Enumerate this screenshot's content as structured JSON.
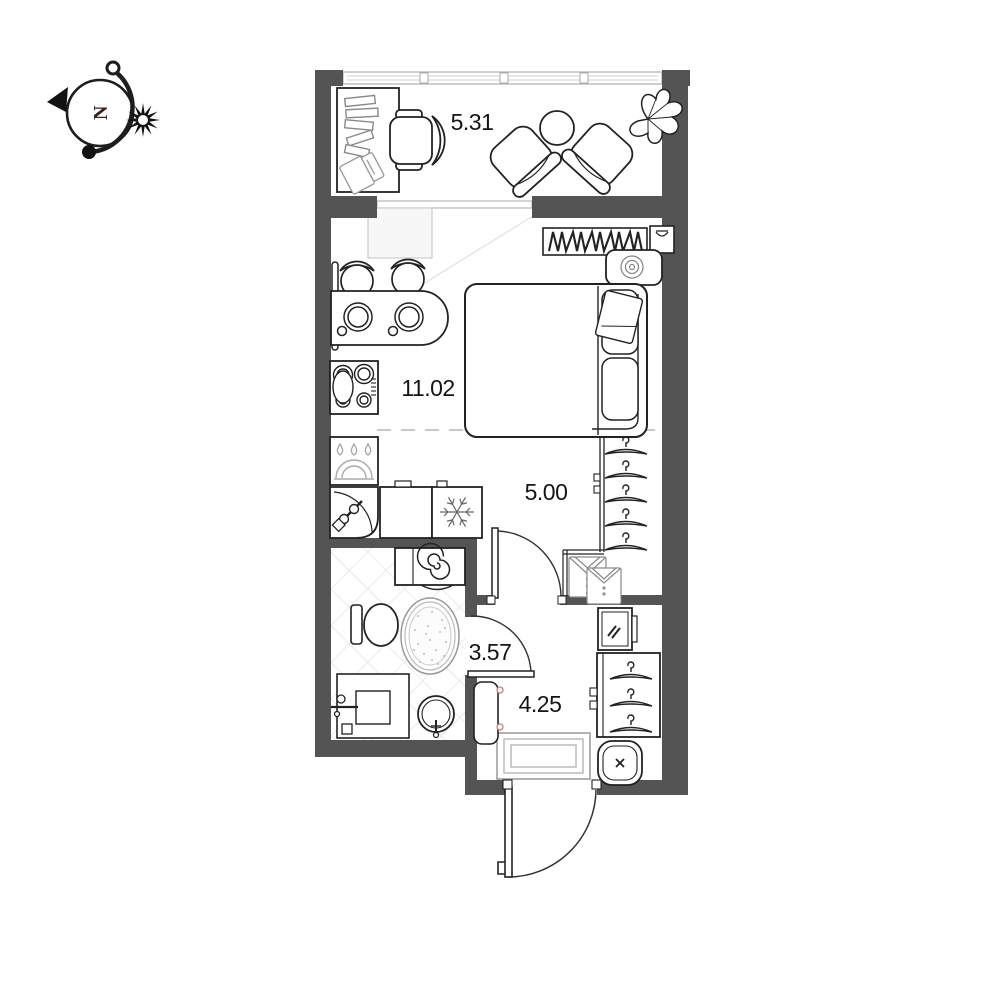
{
  "title": "Studio apartment floor plan",
  "compass": {
    "north_label": "N"
  },
  "plan": {
    "colors": {
      "wall": "#545454",
      "line": "#222222",
      "light_line": "#bbbbbb",
      "tile": "#dddddd",
      "label": "#141414"
    },
    "rooms": [
      {
        "name": "balcony",
        "area": "5.31"
      },
      {
        "name": "living-kitchen",
        "area": "11.02"
      },
      {
        "name": "corridor",
        "area": "5.00"
      },
      {
        "name": "bathroom",
        "area": "3.57"
      },
      {
        "name": "entry-hall",
        "area": "4.25"
      }
    ]
  }
}
